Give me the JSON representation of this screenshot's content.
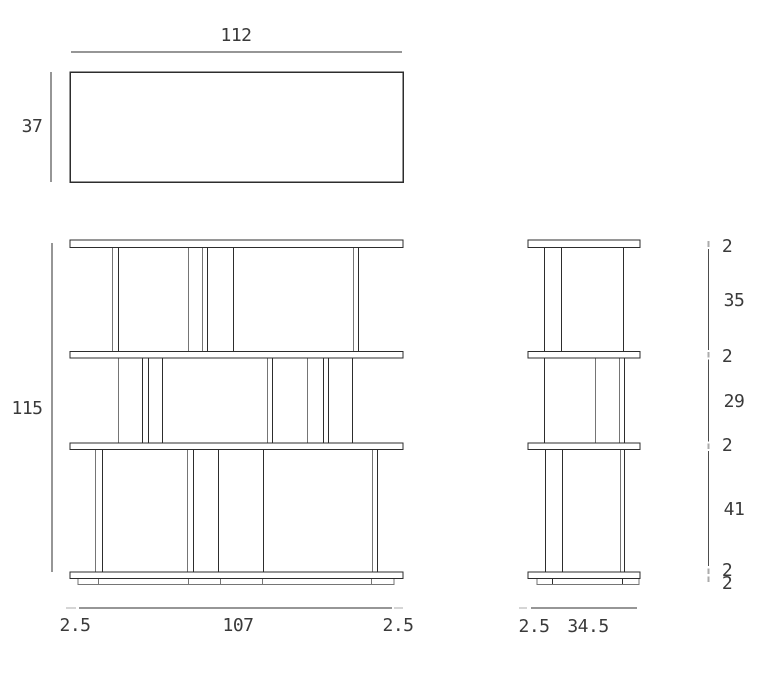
{
  "drawing_title": "shelving unit dimension drawing (three orthographic views)",
  "views": {
    "top": {
      "width": "112",
      "depth": "37"
    },
    "front": {
      "height": "115",
      "bottom": [
        "2.5",
        "107",
        "2.5"
      ]
    },
    "side": {
      "bottom": [
        "2.5",
        "34.5"
      ],
      "right": [
        "2",
        "35",
        "2",
        "29",
        "2",
        "41",
        "2",
        "2"
      ]
    }
  },
  "colors": {
    "line_dark": "#2d2d2d",
    "line_gray": "#757575",
    "dim_line": "#4d4d4d",
    "dim_tick": "#ababab",
    "text": "#3a3a3a",
    "background": "#ffffff"
  }
}
